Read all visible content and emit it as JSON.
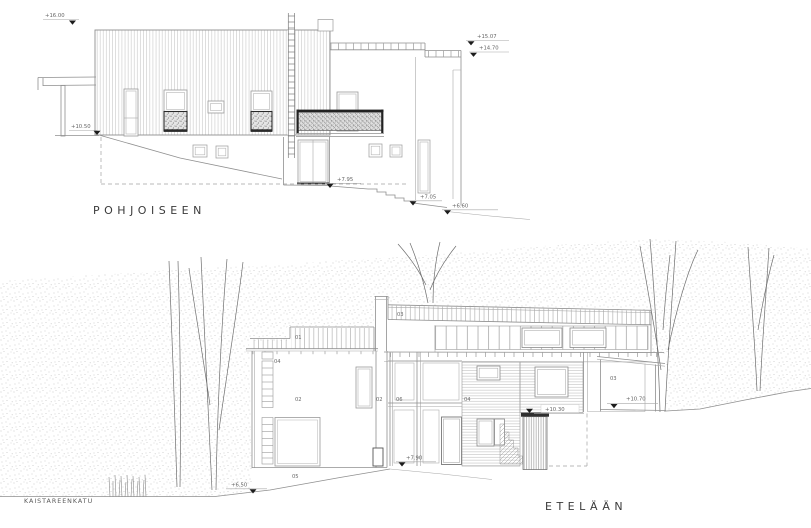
{
  "drawing_type": "architectural elevation drawing",
  "north": {
    "title": "POHJOISEEN",
    "markers": {
      "m1600": "+16.00",
      "m1507": "+15.07",
      "m1470": "+14.70",
      "m1050": "+10.50",
      "m795": "+7.95",
      "m705": "+7.05",
      "m660": "+6.60"
    }
  },
  "south": {
    "title": "ETELÄÄN",
    "street": "KAISTAREENKATU",
    "markers": {
      "m1030": "+10.30",
      "m1070": "+10.70",
      "m790": "+7.90",
      "m650": "+6.50"
    },
    "labels": {
      "roof_left": "01",
      "wall_left": "02",
      "roof_right": "03",
      "win_left": "04",
      "basement": "05",
      "chimney": "02",
      "mid": "06",
      "siding": "04",
      "wing": "03"
    }
  },
  "colors": {
    "line": "#8f8f8f",
    "dark": "#1c1c1c",
    "stipple": "#c3c3c3",
    "background": "#ffffff"
  }
}
